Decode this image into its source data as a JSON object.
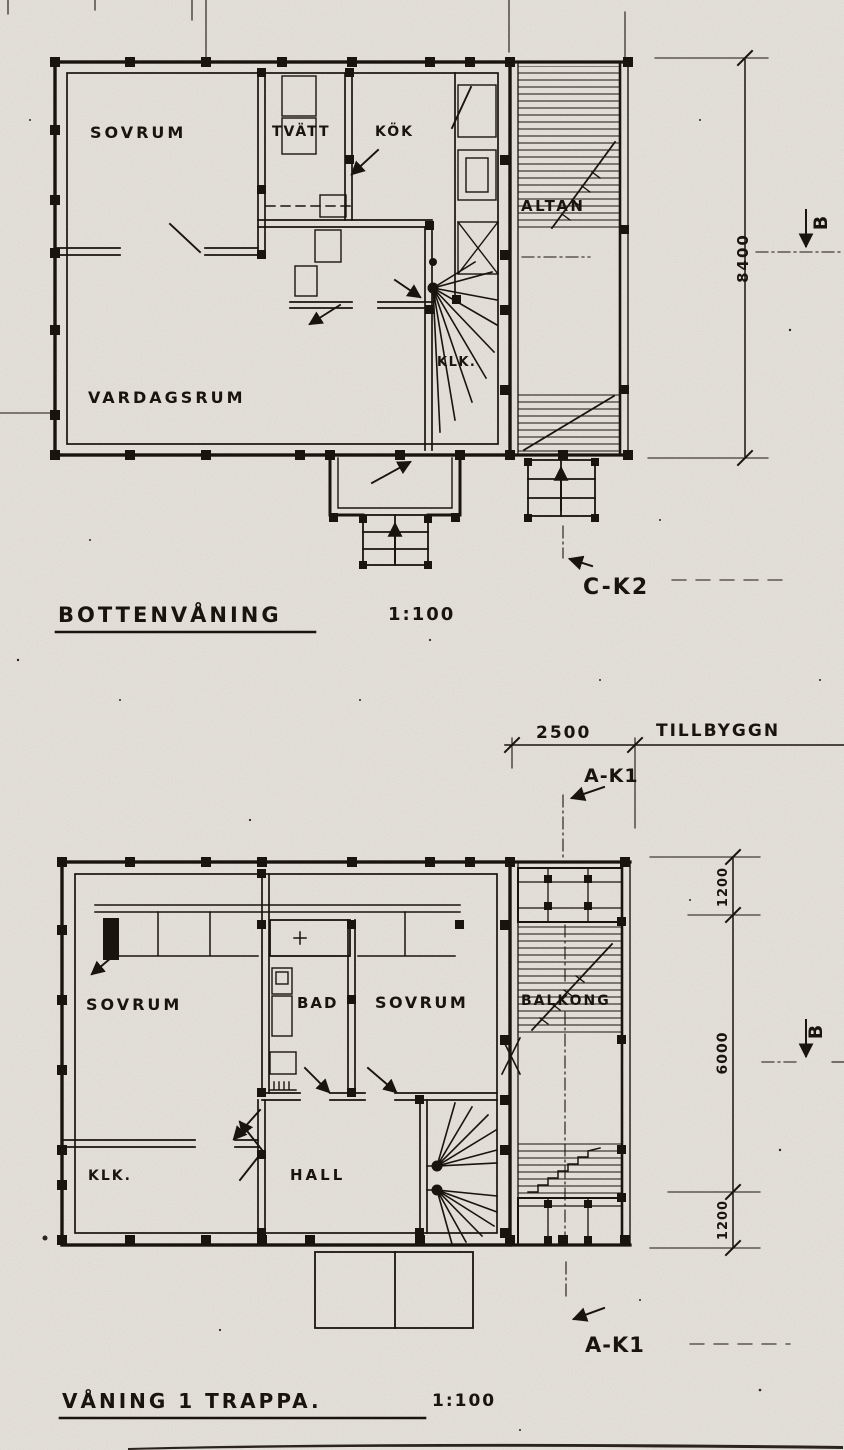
{
  "palette": {
    "paper": "#e9e6df",
    "ink": "#1a140e"
  },
  "ground_floor": {
    "title": "BOTTENVÅNING",
    "scale": "1:100",
    "rooms": {
      "bedroom": "SOVRUM",
      "laundry": "TVÄTT",
      "kitchen": "KÖK",
      "terrace": "ALTAN",
      "closet": "KLK.",
      "living_room": "VARDAGSRUM"
    },
    "dims": {
      "total_depth": "8400"
    },
    "markers": {
      "section_b": "B",
      "section_c": "C-K2"
    }
  },
  "addition": {
    "width": "2500",
    "label": "TILLBYGGN",
    "marker": "A-K1"
  },
  "upper_floor": {
    "title": "VÅNING 1 TRAPPA.",
    "scale": "1:100",
    "rooms": {
      "bedroom_left": "SOVRUM",
      "bathroom": "BAD",
      "bedroom_right": "SOVRUM",
      "balcony": "BALKONG",
      "closet": "KLK.",
      "hall": "HALL"
    },
    "dims": {
      "top": "1200",
      "middle": "6000",
      "bottom": "1200"
    },
    "markers": {
      "section_b": "B",
      "section_a": "A-K1"
    }
  }
}
